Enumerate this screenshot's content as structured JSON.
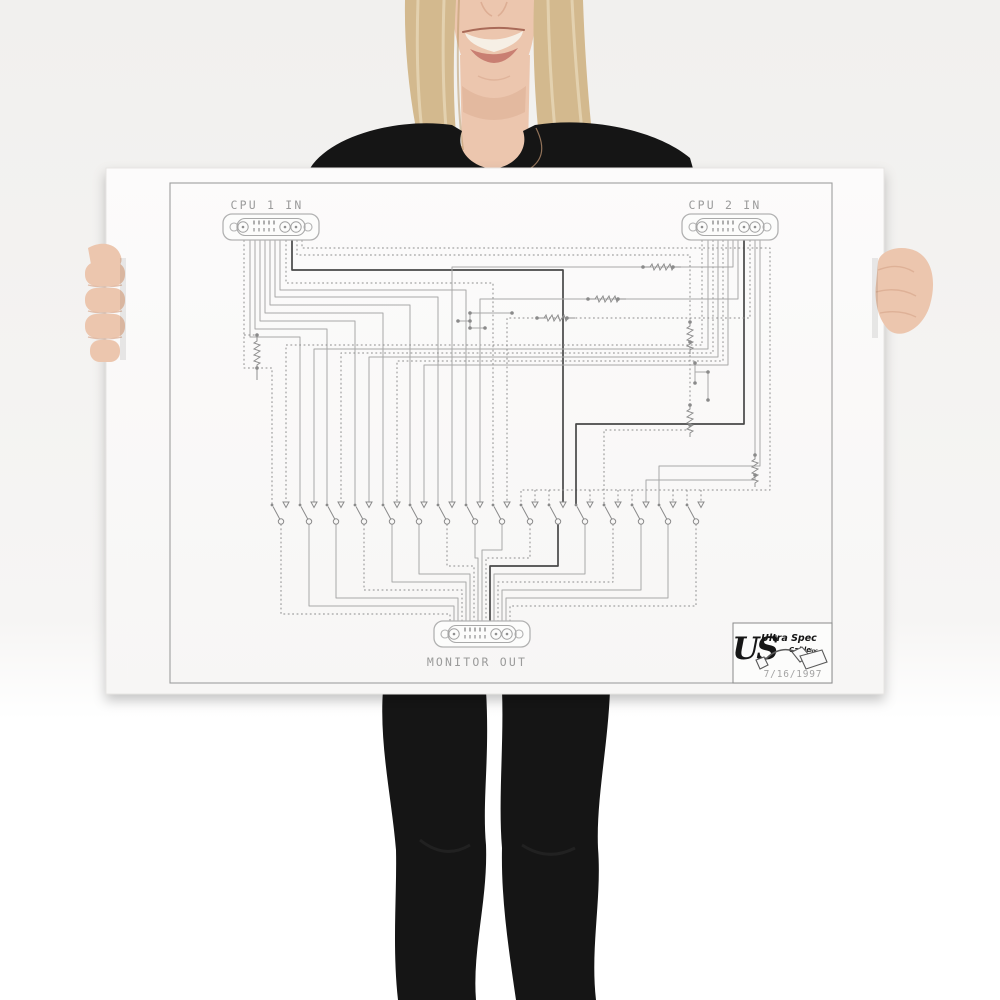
{
  "scene": {
    "description": "Smiling blonde woman in a black top and black leggings holding a large white poster with a cable wiring schematic",
    "background_top": "#f1f0ee",
    "background_bottom": "#ffffff"
  },
  "person": {
    "skin": "#ecc6ae",
    "skin_shadow": "#d9a88d",
    "hair": "#d3b98e",
    "hair_light": "#e9dbbd",
    "hair_dark": "#b3925f",
    "lip": "#c97f72",
    "teeth": "#f6efe5",
    "clothing": "#151515"
  },
  "poster": {
    "paper_color": "#fbfafa",
    "frame_color": "#9e9e9e",
    "labels": {
      "cpu1": "CPU 1 IN",
      "cpu2": "CPU 2 IN",
      "monitor": "MONITOR OUT"
    },
    "logo": {
      "monogram": "US",
      "brand": "Ultra Spec",
      "brand2": "Cable",
      "brand2_suffix": "inc",
      "date": "7/16/1997"
    },
    "line_colors": {
      "light": "#a8a8a8",
      "dotted": "#8d8d8d",
      "dark": "#484848"
    },
    "connectors": {
      "type": "13W3 D-sub",
      "cpu1_cx": 271,
      "cpu1_cy": 227,
      "cpu2_cx": 730,
      "cpu2_cy": 227,
      "monitor_cx": 482,
      "monitor_cy": 634
    },
    "schematic": {
      "switch_y": 505,
      "switch_xs": [
        272,
        300,
        327,
        355,
        383,
        410,
        438,
        466,
        493,
        521,
        549,
        576,
        604,
        632,
        659,
        687
      ],
      "wires": [
        [
          "d",
          244,
          240,
          244,
          368,
          272,
          368,
          272,
          505
        ],
        [
          "l",
          250,
          240,
          250,
          337,
          300,
          337,
          300,
          505
        ],
        [
          "l",
          255,
          240,
          255,
          329,
          327,
          329,
          327,
          505
        ],
        [
          "l",
          260,
          240,
          260,
          321,
          355,
          321,
          355,
          505
        ],
        [
          "l",
          265,
          240,
          265,
          313,
          383,
          313,
          383,
          505
        ],
        [
          "l",
          270,
          240,
          270,
          305,
          410,
          305,
          410,
          505
        ],
        [
          "l",
          275,
          240,
          275,
          297,
          438,
          297,
          438,
          505
        ],
        [
          "l",
          280,
          240,
          280,
          290,
          466,
          290,
          466,
          505
        ],
        [
          "d",
          286,
          240,
          286,
          283,
          493,
          283,
          493,
          505
        ],
        [
          "k",
          292,
          240,
          292,
          270,
          563,
          270,
          563,
          502
        ],
        [
          "d",
          297,
          240,
          297,
          255,
          690,
          255,
          690,
          322
        ],
        [
          "d",
          690,
          342,
          690,
          405
        ],
        [
          "d",
          690,
          425,
          690,
          430,
          604,
          430,
          604,
          505
        ],
        [
          "d",
          302,
          240,
          302,
          248,
          770,
          248,
          770,
          490,
          521,
          490,
          521,
          505
        ],
        [
          "d",
          535,
          490,
          535,
          502
        ],
        [
          "d",
          549,
          490,
          549,
          505
        ],
        [
          "d",
          590,
          490,
          590,
          502
        ],
        [
          "d",
          618,
          490,
          618,
          502
        ],
        [
          "d",
          632,
          490,
          632,
          505
        ],
        [
          "d",
          673,
          490,
          673,
          502
        ],
        [
          "d",
          687,
          490,
          687,
          505
        ],
        [
          "d",
          701,
          490,
          701,
          502
        ],
        [
          "d",
          702,
          240,
          702,
          345,
          286,
          345,
          286,
          502
        ],
        [
          "l",
          708,
          240,
          708,
          349,
          314,
          349,
          314,
          502
        ],
        [
          "d",
          713,
          240,
          713,
          353,
          341,
          353,
          341,
          502
        ],
        [
          "l",
          718,
          240,
          718,
          357,
          369,
          357,
          369,
          502
        ],
        [
          "d",
          723,
          240,
          723,
          361,
          397,
          361,
          397,
          502
        ],
        [
          "l",
          728,
          240,
          728,
          365,
          424,
          365,
          424,
          502
        ],
        [
          "l",
          733,
          240,
          733,
          267,
          452,
          267,
          452,
          502
        ],
        [
          "l",
          738,
          240,
          738,
          299,
          480,
          299,
          480,
          502
        ],
        [
          "k",
          744,
          240,
          744,
          424,
          576,
          424,
          576,
          505
        ],
        [
          "d",
          750,
          240,
          750,
          318,
          507,
          318,
          507,
          502
        ],
        [
          "l",
          755,
          240,
          755,
          455
        ],
        [
          "l",
          755,
          475,
          755,
          480,
          646,
          480,
          646,
          502
        ],
        [
          "l",
          760,
          240,
          760,
          466,
          659,
          466,
          659,
          505
        ],
        [
          "d",
          281,
          524,
          281,
          614,
          450,
          614,
          450,
          627
        ],
        [
          "l",
          309,
          524,
          309,
          606,
          454,
          606,
          454,
          627
        ],
        [
          "l",
          336,
          524,
          336,
          598,
          458,
          598,
          458,
          627
        ],
        [
          "d",
          364,
          524,
          364,
          590,
          462,
          590,
          462,
          627
        ],
        [
          "l",
          392,
          524,
          392,
          582,
          466,
          582,
          466,
          627
        ],
        [
          "l",
          419,
          524,
          419,
          574,
          470,
          574,
          470,
          627
        ],
        [
          "d",
          447,
          524,
          447,
          566,
          474,
          566,
          474,
          627
        ],
        [
          "l",
          475,
          524,
          475,
          558,
          478,
          558,
          478,
          627
        ],
        [
          "l",
          502,
          524,
          502,
          550,
          482,
          550,
          482,
          627
        ],
        [
          "d",
          530,
          524,
          530,
          558,
          486,
          558,
          486,
          627
        ],
        [
          "k",
          558,
          524,
          558,
          566,
          490,
          566,
          490,
          627
        ],
        [
          "l",
          585,
          524,
          585,
          574,
          494,
          574,
          494,
          627
        ],
        [
          "d",
          613,
          524,
          613,
          582,
          498,
          582,
          498,
          627
        ],
        [
          "l",
          641,
          524,
          641,
          590,
          502,
          590,
          502,
          627
        ],
        [
          "l",
          668,
          524,
          668,
          598,
          506,
          598,
          506,
          627
        ],
        [
          "d",
          696,
          524,
          696,
          606,
          510,
          606,
          510,
          627
        ],
        [
          "d",
          244,
          335,
          257,
          335
        ]
      ],
      "link_segments": [
        [
          "l",
          458,
          321,
          470,
          321
        ],
        [
          "l",
          470,
          313,
          512,
          313
        ],
        [
          "l",
          470,
          328,
          485,
          328
        ],
        [
          "l",
          470,
          313,
          470,
          328
        ],
        [
          "l",
          695,
          363,
          695,
          383
        ],
        [
          "l",
          695,
          372,
          708,
          372
        ],
        [
          "l",
          708,
          372,
          708,
          400
        ]
      ],
      "resistors_h": [
        [
          643,
          267
        ],
        [
          588,
          299
        ],
        [
          537,
          318
        ]
      ],
      "resistors_v": [
        [
          257,
          337,
          31
        ],
        [
          690,
          322,
          20
        ],
        [
          690,
          405,
          20
        ],
        [
          755,
          455,
          20
        ]
      ],
      "dots": [
        [
          458,
          321
        ],
        [
          470,
          321
        ],
        [
          470,
          313
        ],
        [
          512,
          313
        ],
        [
          470,
          328
        ],
        [
          485,
          328
        ],
        [
          695,
          363
        ],
        [
          695,
          383
        ],
        [
          708,
          372
        ],
        [
          708,
          400
        ],
        [
          257,
          335
        ],
        [
          257,
          368
        ],
        [
          690,
          322
        ],
        [
          690,
          342
        ],
        [
          690,
          405
        ],
        [
          690,
          425
        ],
        [
          755,
          455
        ],
        [
          755,
          475
        ],
        [
          643,
          267
        ],
        [
          673,
          267
        ],
        [
          588,
          299
        ],
        [
          618,
          299
        ],
        [
          537,
          318
        ],
        [
          567,
          318
        ]
      ]
    }
  }
}
